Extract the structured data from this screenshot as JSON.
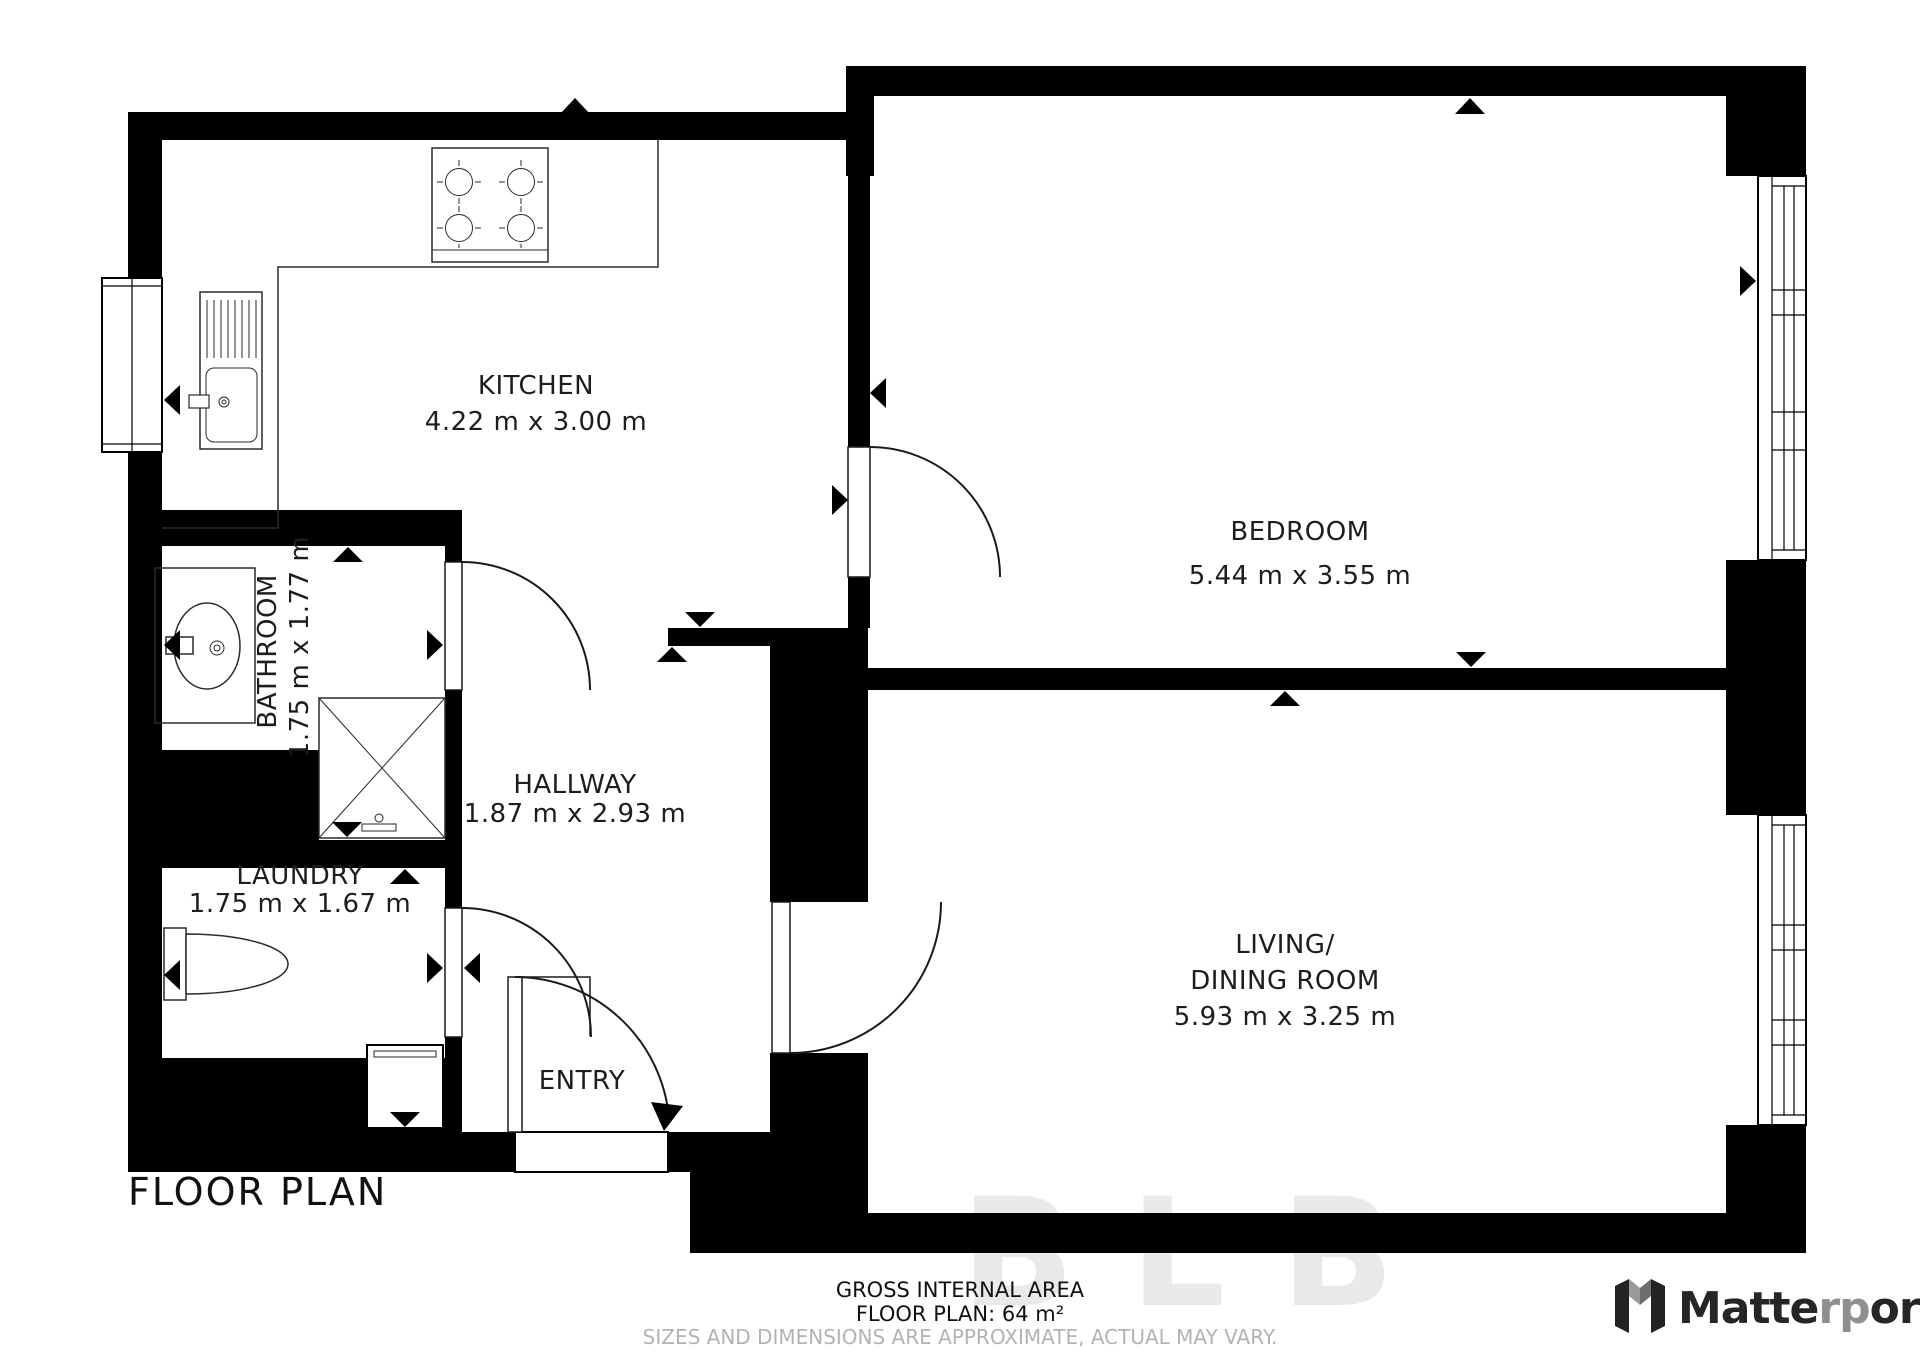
{
  "colors": {
    "wall": "#000000",
    "text": "#1d1d1d",
    "muted_text": "#b3b3b3",
    "logo_dark": "#262626",
    "logo_accent": "#8f8f8f"
  },
  "rooms": {
    "kitchen": {
      "name": "KITCHEN",
      "dims": "4.22 m x 3.00 m"
    },
    "bedroom": {
      "name": "BEDROOM",
      "dims": "5.44 m x 3.55 m"
    },
    "bathroom": {
      "name": "BATHROOM",
      "dims": "1.75 m x 1.77 m"
    },
    "hallway": {
      "name": "HALLWAY",
      "dims": "1.87 m x 2.93 m"
    },
    "laundry": {
      "name": "LAUNDRY",
      "dims": "1.75 m x 1.67 m"
    },
    "entry": {
      "name": "ENTRY"
    },
    "living": {
      "name_line1": "LIVING/",
      "name_line2": "DINING ROOM",
      "dims": "5.93 m x 3.25 m"
    }
  },
  "footer": {
    "plan_title": "FLOOR PLAN",
    "area_label": "GROSS INTERNAL AREA",
    "area_value": "FLOOR PLAN: 64 m²",
    "disclaimer": "SIZES AND DIMENSIONS ARE APPROXIMATE, ACTUAL MAY VARY."
  },
  "logo": {
    "brand_prefix": "Matte",
    "brand_mid": "rp",
    "brand_suffix": "ort"
  },
  "watermark": "BLB",
  "icons": {
    "direction_marker": "solid black triangle",
    "door": "quarter-circle swing arc with leaf",
    "window": "double-line glazing band"
  }
}
